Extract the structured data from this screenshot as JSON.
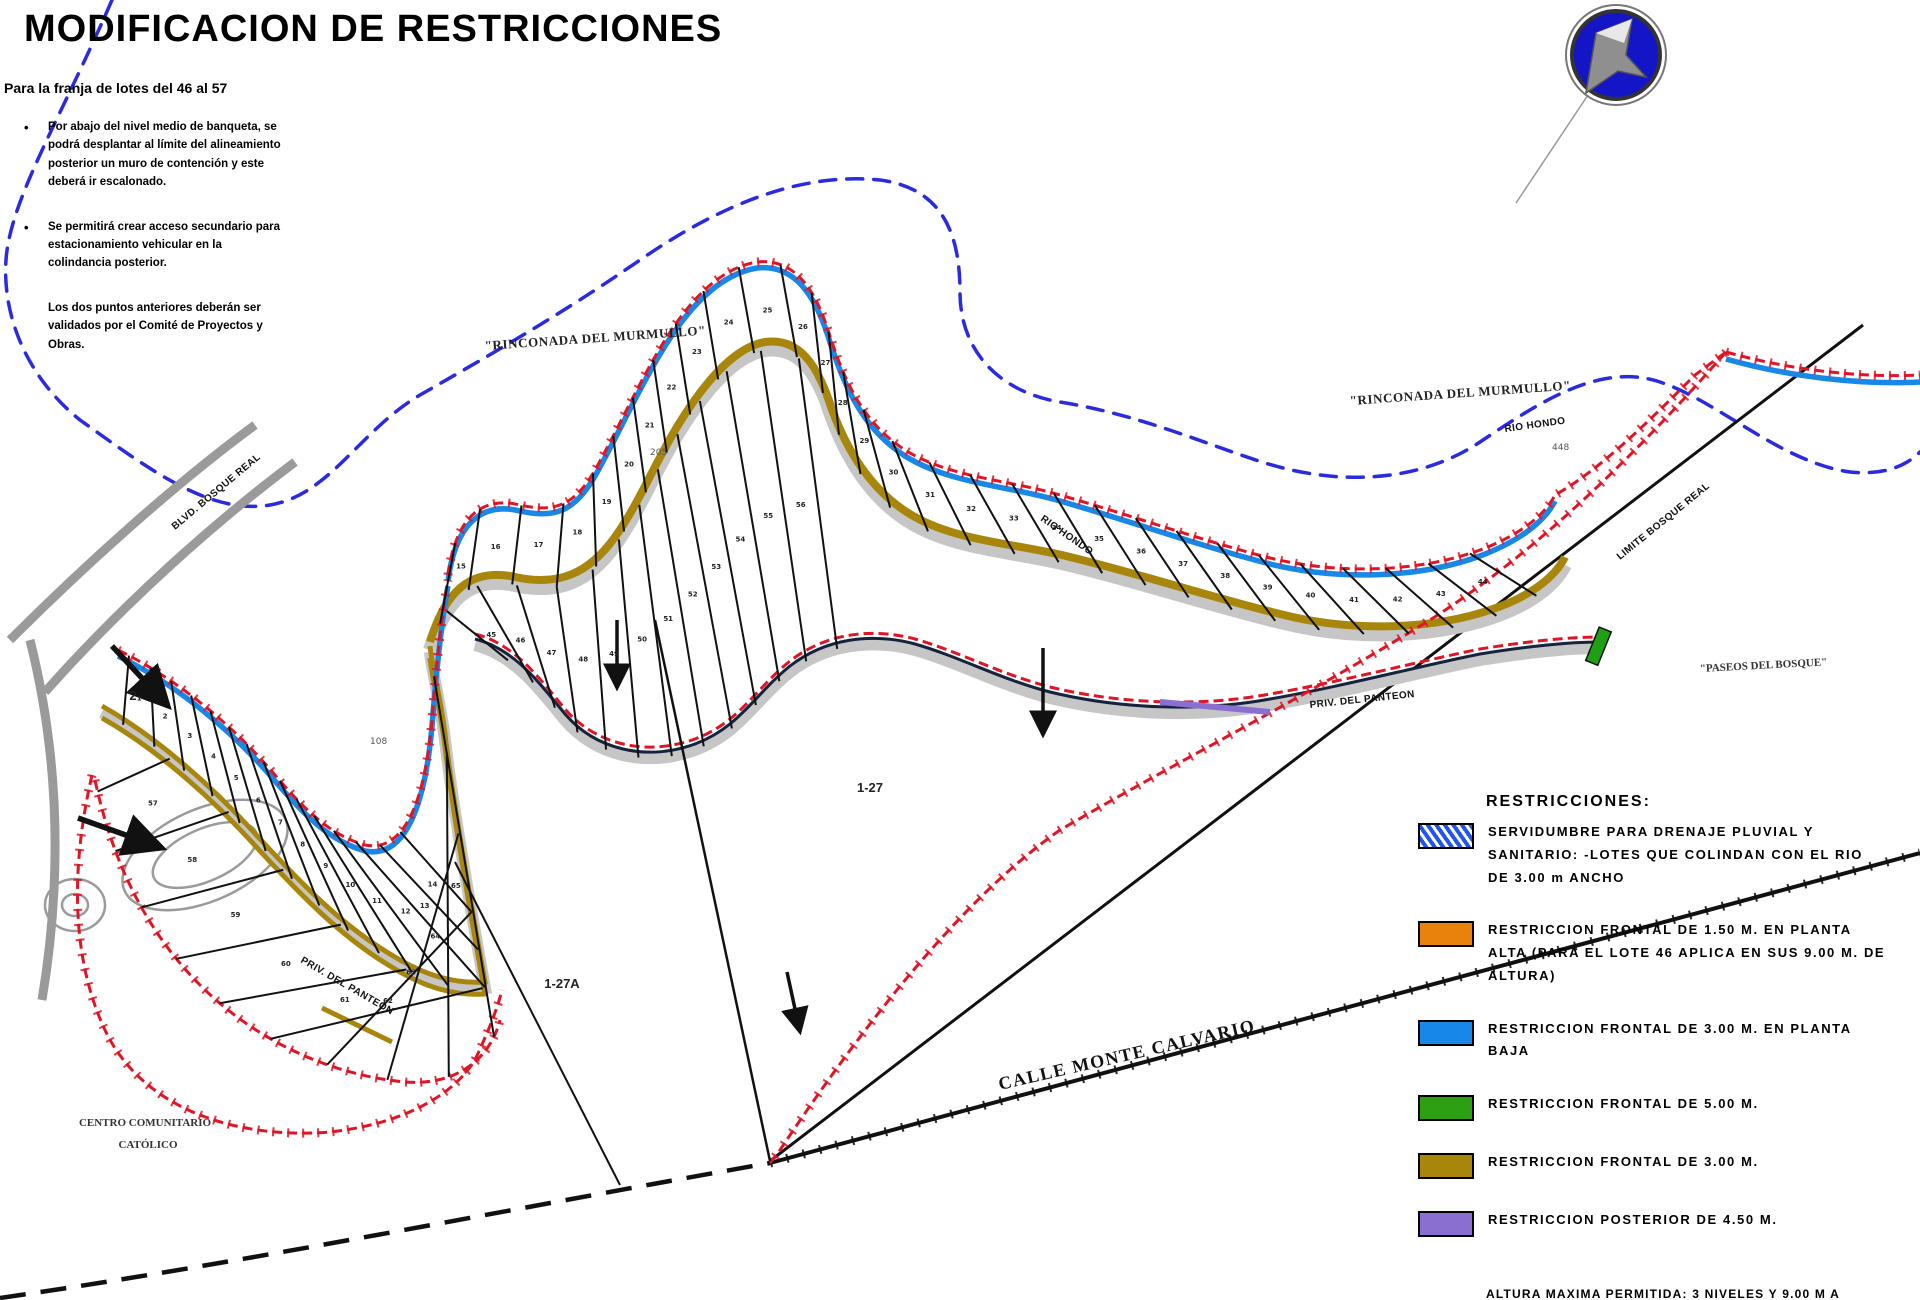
{
  "title": "MODIFICACION DE RESTRICCIONES",
  "subtitle": "Para la franja de lotes del 46 al 57",
  "notes": [
    {
      "bullet": true,
      "text": "Por abajo del nivel medio de banqueta, se podrá desplantar al límite del alineamiento posterior un muro de contención y este deberá ir escalonado."
    },
    {
      "bullet": true,
      "text": "Se permitirá crear acceso secundario para estacionamiento vehicular en la colindancia posterior."
    },
    {
      "bullet": false,
      "text": "Los dos puntos anteriores deberán ser validados por el Comité de Proyectos y Obras."
    }
  ],
  "legend": {
    "heading": "RESTRICCIONES:",
    "items": [
      {
        "hatch": true,
        "color": "#2255ee",
        "text": "SERVIDUMBRE PARA DRENAJE PLUVIAL Y SANITARIO: -LOTES QUE COLINDAN CON EL RIO DE 3.00 m ANCHO"
      },
      {
        "hatch": false,
        "color": "#e8820c",
        "text": "RESTRICCION FRONTAL DE 1.50 M. EN PLANTA ALTA (PARA EL LOTE 46 APLICA EN SUS 9.00 M. DE ALTURA)"
      },
      {
        "hatch": false,
        "color": "#1787e8",
        "text": "RESTRICCION FRONTAL DE 3.00 M. EN PLANTA BAJA"
      },
      {
        "hatch": false,
        "color": "#2ca012",
        "text": "RESTRICCION FRONTAL DE 5.00 M."
      },
      {
        "hatch": false,
        "color": "#a8860b",
        "text": "RESTRICCION FRONTAL DE 3.00 M."
      },
      {
        "hatch": false,
        "color": "#8b6fd0",
        "text": "RESTRICCION POSTERIOR DE 4.50 M."
      }
    ],
    "footnote": "ALTURA MAXIMA PERMITIDA: 3 NIVELES Y 9.00 M A PARTIR DEL NIVEL MEDIO DE BANQUETA, CON RESPECTO AL FRENTE DEL LOTE"
  },
  "map": {
    "labels": {
      "rinconada_left": "\"RINCONADA DEL MURMULLO\"",
      "rinconada_right": "\"RINCONADA DEL MURMULLO\"",
      "paseos": "\"PASEOS DEL BOSQUE\"",
      "calle": "CALLE MONTE CALVARIO",
      "centro_line1": "CENTRO COMUNITARIO",
      "centro_line2": "CATÓLICO",
      "blvd": "BLVD. BOSQUE REAL",
      "limite": "LIMITE BOSQUE REAL",
      "rio_1": "RIO HONDO",
      "rio_2": "RIO HONDO",
      "priv_1": "PRIV. DEL PANTEON",
      "priv_2": "PRIV. DEL PANTEON",
      "parcel_1": "1-27",
      "parcel_2": "1-27A",
      "parcel_3": "2"
    },
    "dims": [
      "205",
      "108",
      "448"
    ],
    "bands": [
      {
        "top": "E1",
        "bottom": "G1",
        "n": 31,
        "t0": 0.02,
        "t1": 0.8,
        "b0": 0.02,
        "b1": 0.97,
        "first": 15,
        "last": 44
      },
      {
        "top": "G1",
        "bottom": "G2",
        "n": 13,
        "t0": 0.03,
        "t1": 0.37,
        "b0": 0.03,
        "b1": 0.36,
        "first": 45,
        "last": 56
      },
      {
        "top": "E2",
        "bottom": "G3",
        "n": 15,
        "t0": 0.02,
        "t1": 0.58,
        "b0": 0.03,
        "b1": 0.68,
        "first": 1,
        "last": 14
      },
      {
        "top": "G3",
        "bottom": "E3",
        "n": 10,
        "t0": 0.1,
        "t1": 0.97,
        "b0": 0.02,
        "b1": 0.97,
        "first": 57,
        "last": 65
      }
    ]
  }
}
